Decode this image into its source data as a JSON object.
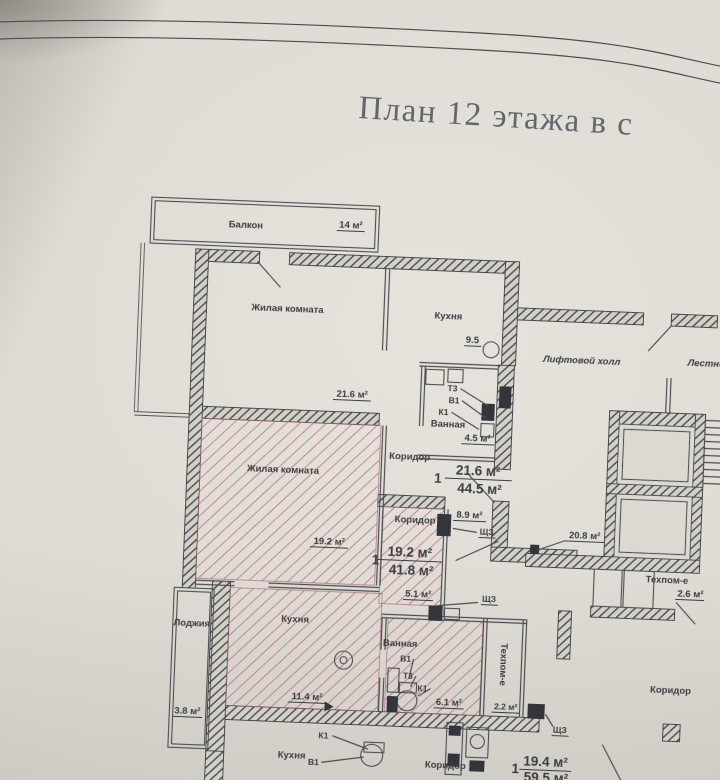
{
  "title": "План 12 этажа в с",
  "colors": {
    "paper": "#dcd9d2",
    "ink": "#45474c",
    "highlight_hatch": "#b4566e",
    "title_text": "#62666d"
  },
  "plan": {
    "balcony": {
      "name": "Балкон",
      "area": "14 м²"
    },
    "living_top": {
      "name": "Жилая комната",
      "area": "21.6 м²"
    },
    "kitchen_top": {
      "name": "Кухня",
      "area": "9.5"
    },
    "bath_top": {
      "name": "Ванная",
      "area": "4.5 м²"
    },
    "corridor_top": {
      "name": "Коридор"
    },
    "risers_top": {
      "t3": "Т3",
      "v1": "В1",
      "k1": "К1"
    },
    "apt1": {
      "num": "1",
      "area_living": "21.6 м²",
      "area_total": "44.5 м²"
    },
    "hall": {
      "name": "Лифтовой холл"
    },
    "stairs": {
      "name": "Лестничн"
    },
    "area_89": {
      "area": "8.9 м²",
      "panel": "ЩЗ"
    },
    "living_mid": {
      "name": "Жилая комната",
      "area": "19.2 м²"
    },
    "corridor_mid": {
      "name": "Коридор"
    },
    "apt2": {
      "num": "1",
      "area_living": "19.2 м²",
      "area_total": "41.8 м²"
    },
    "area_51": {
      "area": "5.1 м²",
      "panel": "ЩЗ"
    },
    "corridor_common": {
      "area": "20.8 м²"
    },
    "tech_right": {
      "name": "Техпом-е",
      "area": "2.6 м²"
    },
    "loggia": {
      "name": "Лоджия",
      "area": "3.8 м²"
    },
    "kitchen_mid": {
      "name": "Кухня",
      "area": "11.4 м²"
    },
    "bath_mid": {
      "name": "Ванная",
      "area": "6.1 м²"
    },
    "risers_mid": {
      "v1": "В1",
      "t3": "Т3",
      "k1": "К1"
    },
    "tech_mid": {
      "name": "Техпом-е",
      "area": "2.2 м²"
    },
    "kitchen_bottom": {
      "name": "Кухня"
    },
    "risers_bottom": {
      "k1": "К1",
      "v1": "В1"
    },
    "corridor_bottom": {
      "name": "Коридор"
    },
    "panel_bottom": {
      "panel": "ЩЗ"
    },
    "apt3": {
      "num": "1",
      "area_living": "19.4 м²",
      "area_total": "59.5 м²"
    },
    "corridor_right": {
      "name": "Коридор"
    }
  }
}
